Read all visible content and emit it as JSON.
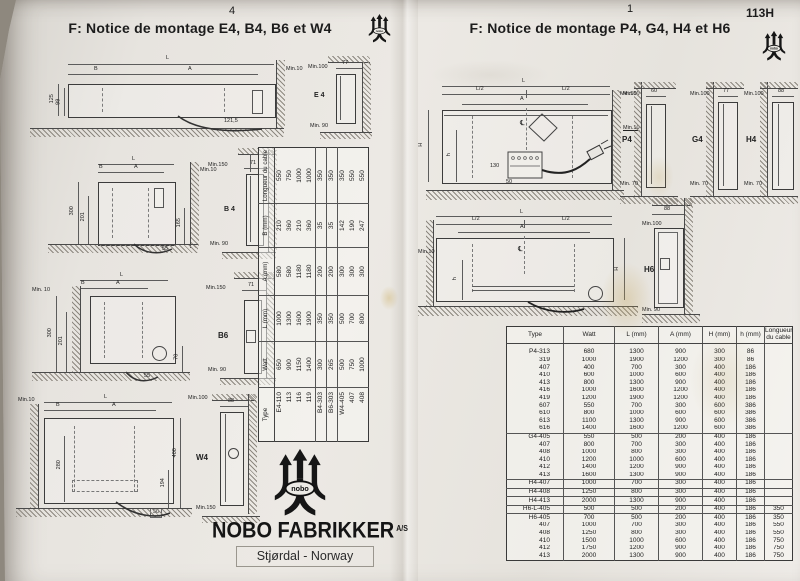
{
  "brand": {
    "logo_text": "nobo"
  },
  "left_page": {
    "page_number": "4",
    "title": "F: Notice de montage E4, B4, B6 et W4",
    "diagram_e4": {
      "l": "L",
      "b": "B",
      "a": "A",
      "min10": "Min.10",
      "h125": "125",
      "h99": "99",
      "cable": "121,5",
      "s_top": "Min.100",
      "s_w": "77",
      "s_label": "E 4",
      "s_bot": "Min. 90"
    },
    "diagram_b4": {
      "l": "L",
      "b": "B",
      "a": "A",
      "min10": "Min.10",
      "h300": "300",
      "h201": "201",
      "h165": "165",
      "cable": "55",
      "s_top": "Min.150",
      "s_w": "71",
      "s_label": "B 4",
      "s_bot": "Min. 90"
    },
    "diagram_b6": {
      "min10": "Min. 10",
      "l": "L",
      "b": "B",
      "a": "A",
      "h300": "300",
      "h201": "201",
      "h70": "70",
      "cable": "55",
      "s_top": "Min.150",
      "s_w": "71",
      "s_label": "B6",
      "s_bot": "Min. 90"
    },
    "diagram_w4": {
      "min10": "Min.10",
      "l": "L",
      "b": "B",
      "a": "A",
      "h280": "280",
      "h400": "400",
      "h194": "194",
      "cable": "50",
      "s_top": "Min.100",
      "s_w": "88",
      "s_label": "W4",
      "s_bot": "Min.150"
    },
    "table": {
      "headers": [
        "Type",
        "Watt",
        "L (mm)",
        "A (mm)",
        "B (mm)",
        "Longueur du cable"
      ],
      "rows": [
        [
          "E4-110",
          "650",
          "1000",
          "580",
          "210",
          "550"
        ],
        [
          "113",
          "900",
          "1300",
          "580",
          "360",
          "750"
        ],
        [
          "116",
          "1150",
          "1600",
          "1180",
          "210",
          "1000"
        ],
        [
          "119",
          "1400",
          "1900",
          "1180",
          "360",
          "1000"
        ],
        [
          "B4-303",
          "300",
          "350",
          "200",
          "35",
          "350"
        ],
        [
          "B6-303",
          "265",
          "350",
          "200",
          "35",
          "350"
        ],
        [
          "W4-405",
          "500",
          "500",
          "300",
          "142",
          "350"
        ],
        [
          "407",
          "750",
          "700",
          "300",
          "190",
          "550"
        ],
        [
          "408",
          "1000",
          "800",
          "300",
          "247",
          "550"
        ]
      ],
      "group_starts": [
        0,
        4,
        5,
        6
      ]
    },
    "footer": {
      "brand": "NOBO FABRIKKER",
      "brand_suffix": "A/S",
      "location": "Stjørdal - Norway"
    }
  },
  "right_page": {
    "page_number": "1",
    "doc_code": "113H",
    "title": "F: Notice de montage P4, G4, H4 et H6",
    "front1": {
      "l": "L",
      "l2a": "L/2",
      "l2b": "L/2",
      "a": "A",
      "h": "H",
      "hs": "h",
      "d130": "130",
      "d50": "50",
      "min50": "Min.50",
      "min10": "Min.10",
      "cl": "℄"
    },
    "side_p4": {
      "top": "Min.50",
      "w": "60",
      "label": "P4",
      "bot": "Min. 70"
    },
    "side_g4": {
      "top": "Min.100",
      "w": "77",
      "label": "G4",
      "bot": "Min. 70"
    },
    "side_h4": {
      "top": "Min.100",
      "w": "88",
      "label": "H4",
      "bot": "Min. 70"
    },
    "front2": {
      "l": "L",
      "l2a": "L/2",
      "l2b": "L/2",
      "a": "A",
      "h": "H",
      "hs": "h",
      "min10": "Min.10",
      "cl": "℄"
    },
    "side_h6": {
      "top": "Min.100",
      "w": "88",
      "label": "H6",
      "bot": "Min. 90"
    },
    "table": {
      "headers": [
        "Type",
        "Watt",
        "L (mm)",
        "A (mm)",
        "H (mm)",
        "h (mm)",
        "Longueur du cable"
      ],
      "rows": [
        [
          "P4-313",
          "680",
          "1300",
          "900",
          "300",
          "86",
          ""
        ],
        [
          "319",
          "1000",
          "1900",
          "1200",
          "300",
          "86",
          ""
        ],
        [
          "407",
          "400",
          "700",
          "300",
          "400",
          "186",
          ""
        ],
        [
          "410",
          "600",
          "1000",
          "600",
          "400",
          "186",
          ""
        ],
        [
          "413",
          "800",
          "1300",
          "900",
          "400",
          "186",
          ""
        ],
        [
          "416",
          "1000",
          "1600",
          "1200",
          "400",
          "186",
          ""
        ],
        [
          "419",
          "1200",
          "1900",
          "1200",
          "400",
          "186",
          ""
        ],
        [
          "607",
          "550",
          "700",
          "300",
          "600",
          "386",
          ""
        ],
        [
          "610",
          "800",
          "1000",
          "600",
          "600",
          "386",
          ""
        ],
        [
          "613",
          "1100",
          "1300",
          "900",
          "600",
          "386",
          ""
        ],
        [
          "616",
          "1400",
          "1600",
          "1200",
          "600",
          "386",
          ""
        ],
        [
          "G4-405",
          "550",
          "500",
          "200",
          "400",
          "186",
          ""
        ],
        [
          "407",
          "800",
          "700",
          "300",
          "400",
          "186",
          ""
        ],
        [
          "408",
          "1000",
          "800",
          "300",
          "400",
          "186",
          ""
        ],
        [
          "410",
          "1200",
          "1000",
          "600",
          "400",
          "186",
          ""
        ],
        [
          "412",
          "1400",
          "1200",
          "900",
          "400",
          "186",
          ""
        ],
        [
          "413",
          "1600",
          "1300",
          "900",
          "400",
          "186",
          ""
        ],
        [
          "H4-407",
          "1000",
          "700",
          "300",
          "400",
          "186",
          ""
        ],
        [
          "H4-408",
          "1250",
          "800",
          "300",
          "400",
          "186",
          ""
        ],
        [
          "H4-413",
          "2000",
          "1300",
          "900",
          "400",
          "186",
          ""
        ],
        [
          "H6-L-405",
          "500",
          "500",
          "200",
          "400",
          "186",
          "350"
        ],
        [
          "H6-405",
          "700",
          "500",
          "200",
          "400",
          "186",
          "350"
        ],
        [
          "407",
          "1000",
          "700",
          "300",
          "400",
          "186",
          "550"
        ],
        [
          "408",
          "1250",
          "800",
          "300",
          "400",
          "186",
          "550"
        ],
        [
          "410",
          "1500",
          "1000",
          "600",
          "400",
          "186",
          "750"
        ],
        [
          "412",
          "1750",
          "1200",
          "900",
          "400",
          "186",
          "750"
        ],
        [
          "413",
          "2000",
          "1300",
          "900",
          "400",
          "186",
          "750"
        ]
      ],
      "group_starts": [
        0,
        11,
        17,
        18,
        19,
        20,
        21
      ]
    }
  }
}
